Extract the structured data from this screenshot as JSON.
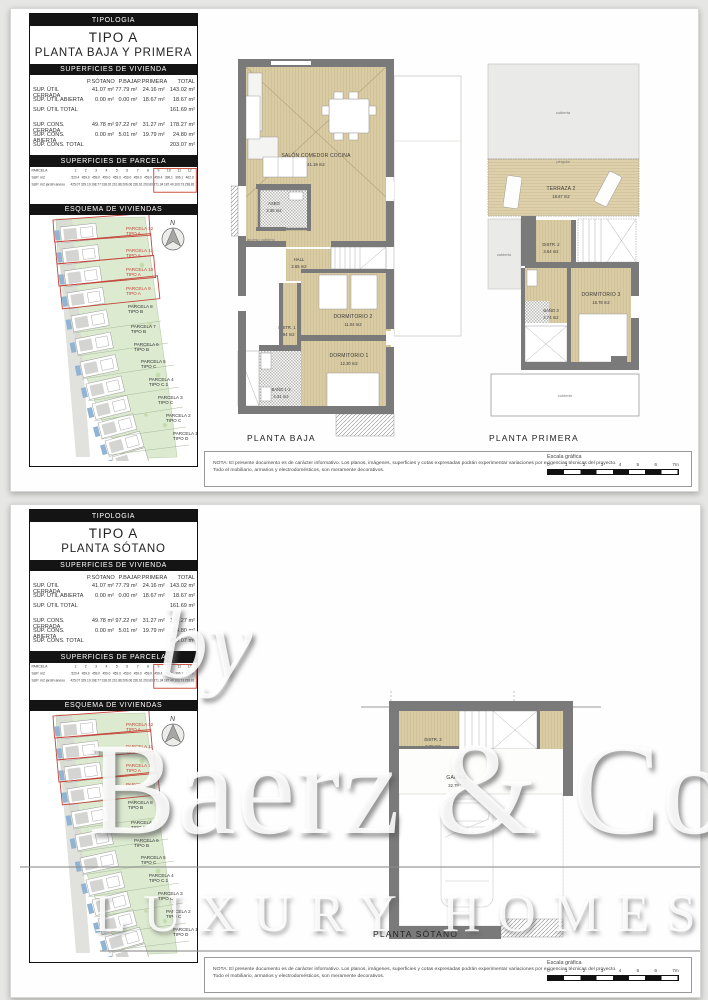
{
  "panel": {
    "tipologia": "TIPOLOGIA",
    "tipo": "TIPO A",
    "superficies_vivienda": "SUPERFICIES DE VIVIENDA",
    "superficies_parcela": "SUPERFICIES DE PARCELA",
    "esquema": "ESQUEMA DE VIVIENDAS",
    "vivienda_cols": [
      "P.SÓTANO",
      "P.BAJA",
      "P.PRIMERA",
      "TOTAL"
    ],
    "vivienda_rows": [
      {
        "label": "SUP. ÚTIL CERRADA",
        "v": [
          "41.07 m²",
          "77.79 m²",
          "24.16 m²",
          "143.02 m²"
        ]
      },
      {
        "label": "SUP. ÚTIL ABIERTA",
        "v": [
          "0.00 m²",
          "0.00 m²",
          "18.67 m²",
          "18.67 m²"
        ]
      },
      {
        "label": "SUP. ÚTIL TOTAL",
        "v": [
          "",
          "",
          "",
          "161.69 m²"
        ]
      },
      {
        "label": "SUP. CONS. CERRADA",
        "v": [
          "49.78 m²",
          "97.22 m²",
          "31.27 m²",
          "178.27 m²"
        ]
      },
      {
        "label": "SUP. CONS. ABIERTA",
        "v": [
          "0.00 m²",
          "5.01 m²",
          "19.79 m²",
          "24.80 m²"
        ]
      },
      {
        "label": "SUP. CONS. TOTAL",
        "v": [
          "",
          "",
          "",
          "203.07 m²"
        ]
      }
    ],
    "parcela_header": "PARCELA",
    "parcela_nums": [
      "1",
      "2",
      "3",
      "4",
      "5",
      "6",
      "7",
      "8",
      "9",
      "10",
      "11",
      "12"
    ],
    "parcela_rows": [
      {
        "label": "SUP. m2",
        "v": [
          "520.4",
          "459.0",
          "459.0",
          "459.0",
          "459.0",
          "459.0",
          "459.0",
          "459.0",
          "459.4",
          "396.1",
          "396.1",
          "462.9"
        ]
      },
      {
        "label": "SUP. m2 jardín anexo",
        "v": [
          "425.07",
          "329.19",
          "198.77",
          "318.02",
          "210.86",
          "206.06",
          "226.61",
          "203.60",
          "271.34",
          "187.40",
          "103.73",
          "238.81"
        ]
      }
    ],
    "compass_n": "N",
    "parcels": [
      {
        "name": "PARCELA 12",
        "tipo": "TIPO A"
      },
      {
        "name": "PARCELA 11",
        "tipo": "TIPO A"
      },
      {
        "name": "PARCELA 10",
        "tipo": "TIPO A"
      },
      {
        "name": "PARCELA 9",
        "tipo": "TIPO A"
      },
      {
        "name": "PARCELA 8",
        "tipo": "TIPO B"
      },
      {
        "name": "PARCELA 7",
        "tipo": "TIPO B"
      },
      {
        "name": "PARCELA 6",
        "tipo": "TIPO B"
      },
      {
        "name": "PARCELA 5",
        "tipo": "TIPO C"
      },
      {
        "name": "PARCELA 4",
        "tipo": "TIPO C.1"
      },
      {
        "name": "PARCELA 3",
        "tipo": "TIPO C"
      },
      {
        "name": "PARCELA 2",
        "tipo": "TIPO C"
      },
      {
        "name": "PARCELA 1",
        "tipo": "TIPO D"
      }
    ]
  },
  "sheet1": {
    "planta": "PLANTA BAJA Y PRIMERA",
    "plan_baja_title": "PLANTA BAJA",
    "plan_primera_title": "PLANTA PRIMERA",
    "baja_rooms": {
      "salon_name": "SALÓN COMEDOR COCINA",
      "salon_area": "41.19 m2",
      "aseo_name": "ASEO",
      "aseo_area": "3.36 m2",
      "hall_name": "HALL",
      "hall_area": "2.65 m2",
      "dorm2_name": "DORMITORIO 2",
      "dorm2_area": "11.04 m2",
      "distr1_name": "DISTR. 1",
      "distr1_area": "2.94 m2",
      "dorm1_name": "DORMITORIO 1",
      "dorm1_area": "12.30 m2",
      "bano12_name": "BAÑO 1-2",
      "bano12_area": "4.31 m2",
      "acceso1": "acceso cubierto",
      "acceso2": "vivienda"
    },
    "primera_rooms": {
      "cubierta": "cubierta",
      "pergola": "pérgola",
      "terraza2_name": "TERRAZA 2",
      "terraza2_area": "18.67 m2",
      "distr2_name": "DISTR. 2",
      "distr2_area": "3.64 m2",
      "dorm3_name": "DORMITORIO 3",
      "dorm3_area": "15.78 m2",
      "bano3_name": "BAÑO 3",
      "bano3_area": "4.74 m2",
      "cubierto_left": "cubierto",
      "cubierto_bottom": "cubierto"
    }
  },
  "sheet2": {
    "planta": "PLANTA SÓTANO",
    "plan_title": "PLANTA SÓTANO",
    "sotano_rooms": {
      "distr3_name": "DISTR. 3",
      "distr3_area": "8.28 m2",
      "garaje_name": "GARAJE",
      "garaje_area": "32.79 m2"
    }
  },
  "footer": {
    "nota1": "NOTA: El presente documento es de carácter informativo. Los planos, imágenes, superficies y cotas expresadas podrán experimentar variaciones por exigencias técnicas del proyecto.",
    "nota2": "Todo el mobiliario, armarios y electrodomésticos, son meramente decorativos.",
    "escala_label": "Escala gráfica",
    "ticks": [
      "0",
      "1",
      "2",
      "3",
      "4",
      "5",
      "6",
      "7m"
    ]
  },
  "watermark": {
    "by": "by",
    "brand": "Baerz & Co",
    "tagline": "LUXURY HOMES"
  },
  "colors": {
    "floor_beige": "#d9cba3",
    "wall_gray": "#7a7a7a",
    "site_green": "#dcead0",
    "pool_blue": "#8fb4d4",
    "parcel_red": "#c4453a"
  }
}
